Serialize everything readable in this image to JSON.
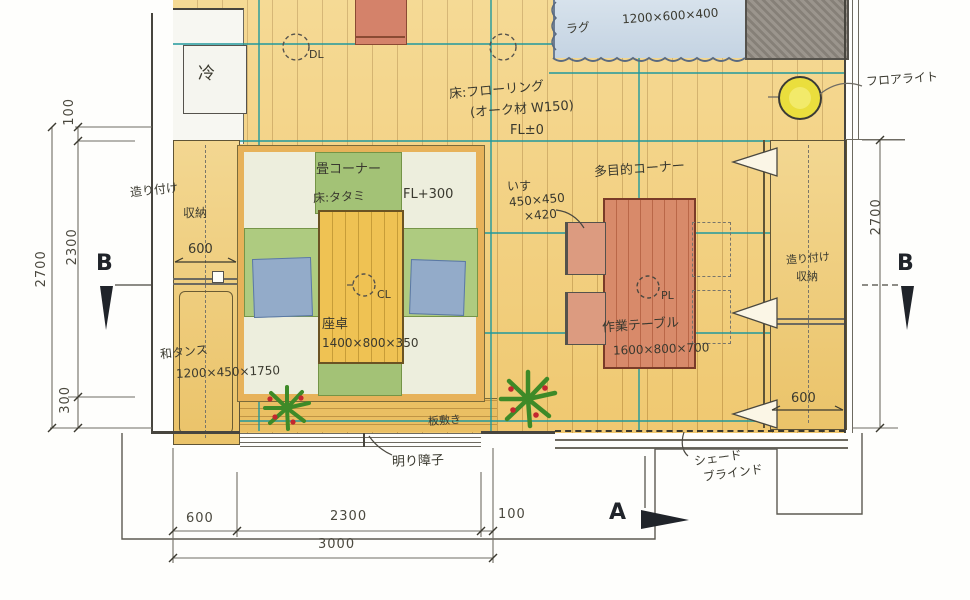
{
  "palette": {
    "floor_yellow": "#f2cf7a",
    "tatami_green": "#a8c87a",
    "tatami_pale": "#edeedd",
    "table_red": "#d88a6a",
    "rug_blue": "#ccd9e6",
    "grid_teal": "#20989c",
    "light_yellow": "#eade3d",
    "ink": "#3a392f"
  },
  "room": {
    "fridge_label": "冷",
    "floor_notes": {
      "l1": "床:フローリング",
      "l2": "(オーク材 W150)",
      "l3": "FL±0"
    },
    "rug": {
      "label": "ラグ",
      "dims": "1200×600×400"
    },
    "floor_light": "フロアライト",
    "lights": {
      "dl": "DL",
      "cl": "CL",
      "pl": "PL"
    },
    "tatami": {
      "title": "畳コーナー",
      "floor": "床:タタミ",
      "level": "FL+300",
      "table": "座卓",
      "table_dims": "1400×800×350"
    },
    "storage_left": {
      "l1": "造り付け",
      "l2": "収納",
      "depth": "600"
    },
    "tansu": {
      "label": "和タンス",
      "dims": "1200×450×1750"
    },
    "multi": {
      "title": "多目的コーナー",
      "chair": "いす",
      "chair_dims1": "450×450",
      "chair_dims2": "×420",
      "table": "作業テーブル",
      "table_dims": "1600×800×700"
    },
    "storage_right": {
      "l1": "造り付け",
      "l2": "収納",
      "depth": "600"
    },
    "deck": "板敷き",
    "shoji": "明り障子",
    "shade": {
      "l1": "シェード",
      "l2": "ブラインド"
    }
  },
  "dims": {
    "left": {
      "d100": "100",
      "d2300": "2300",
      "d300": "300",
      "total": "2700"
    },
    "bottom": {
      "d600": "600",
      "d2300": "2300",
      "d100": "100",
      "total": "3000"
    },
    "right": {
      "total": "2700"
    }
  },
  "sections": {
    "a": "A",
    "b": "B"
  }
}
